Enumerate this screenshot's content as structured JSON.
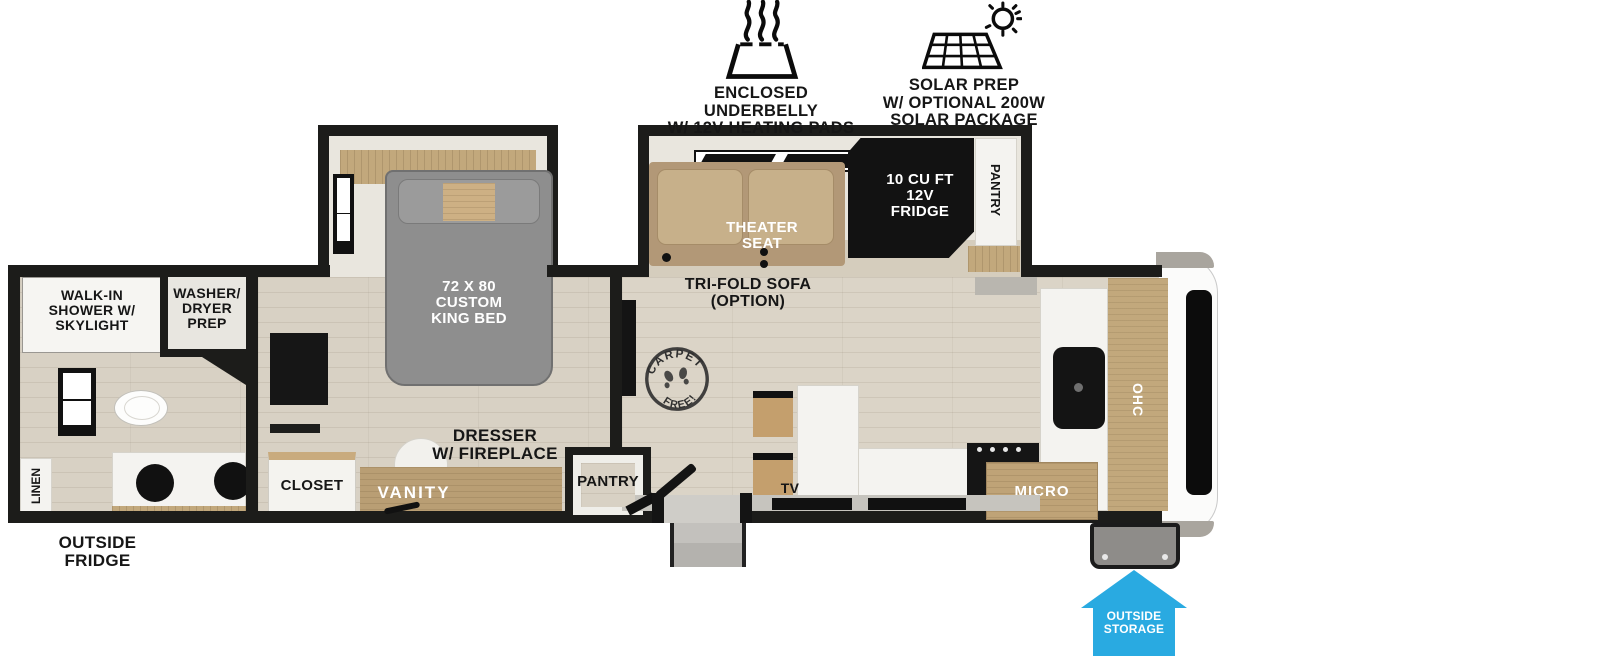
{
  "badges": {
    "underbelly": "ENCLOSED UNDERBELLY\nW/ 12V HEATING PADS",
    "solar": "SOLAR PREP\nW/ OPTIONAL 200W\nSOLAR PACKAGE"
  },
  "labels": {
    "walk_in_shower": "WALK-IN\nSHOWER W/\nSKYLIGHT",
    "washer_dryer_prep": "WASHER/\nDRYER\nPREP",
    "linen": "LINEN",
    "outside_fridge": "OUTSIDE\nFRIDGE",
    "closet": "CLOSET",
    "vanity": "VANITY",
    "dresser_fireplace": "DRESSER\nW/ FIREPLACE",
    "king_bed": "72 X 80\nCUSTOM\nKING BED",
    "bedroom_pantry": "PANTRY",
    "theater_seat": "THEATER\nSEAT",
    "trifold_sofa": "TRI-FOLD SOFA\n(OPTION)",
    "fridge": "10 CU FT\n12V\nFRIDGE",
    "kitchen_pantry": "PANTRY",
    "tv": "TV",
    "micro": "MICRO",
    "ohc": "OHC",
    "outside_storage": "OUTSIDE\nSTORAGE",
    "carpet_stamp_top": "CARPET",
    "carpet_stamp_bottom": "FREE!"
  },
  "colors": {
    "wall": "#1c1c1a",
    "floor": "#d8d1c4",
    "accent_blue": "#29aae1",
    "bed_gray": "#8e8e8e",
    "sofa_tan": "#c7b08a",
    "wood": "#c2a87c"
  }
}
